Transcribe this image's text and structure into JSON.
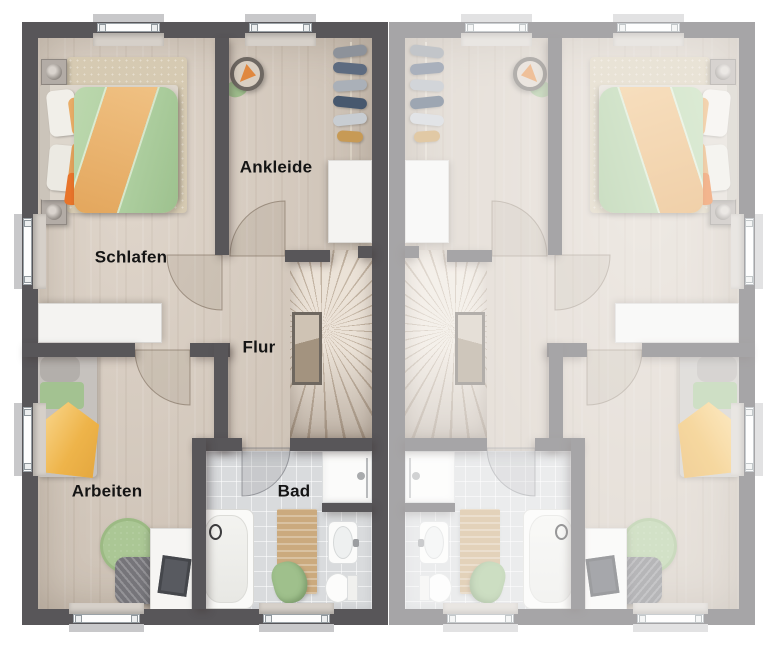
{
  "floorplan": {
    "type": "floor-plan",
    "layout": "semi-detached-mirrored",
    "labeled_unit": "left",
    "rooms": {
      "schlafen": "Schlafen",
      "ankleide": "Ankleide",
      "flur": "Flur",
      "arbeiten": "Arbeiten",
      "bad": "Bad"
    },
    "colors": {
      "wall": "#585659",
      "floor_wood": "#d8ccbf",
      "floor_tile": "#d9dbdd",
      "rug_beige": "#d6cab2",
      "duvet_green": "#aecfa0",
      "blanket_orange": "#e9ad67",
      "throw_yellow": "#f2bc55",
      "rug_green": "#abc795",
      "furniture_white": "#f4f3f1",
      "label_text": "#141414",
      "background": "#ffffff",
      "fade_overlay": "rgba(255,255,255,0.47)"
    }
  }
}
